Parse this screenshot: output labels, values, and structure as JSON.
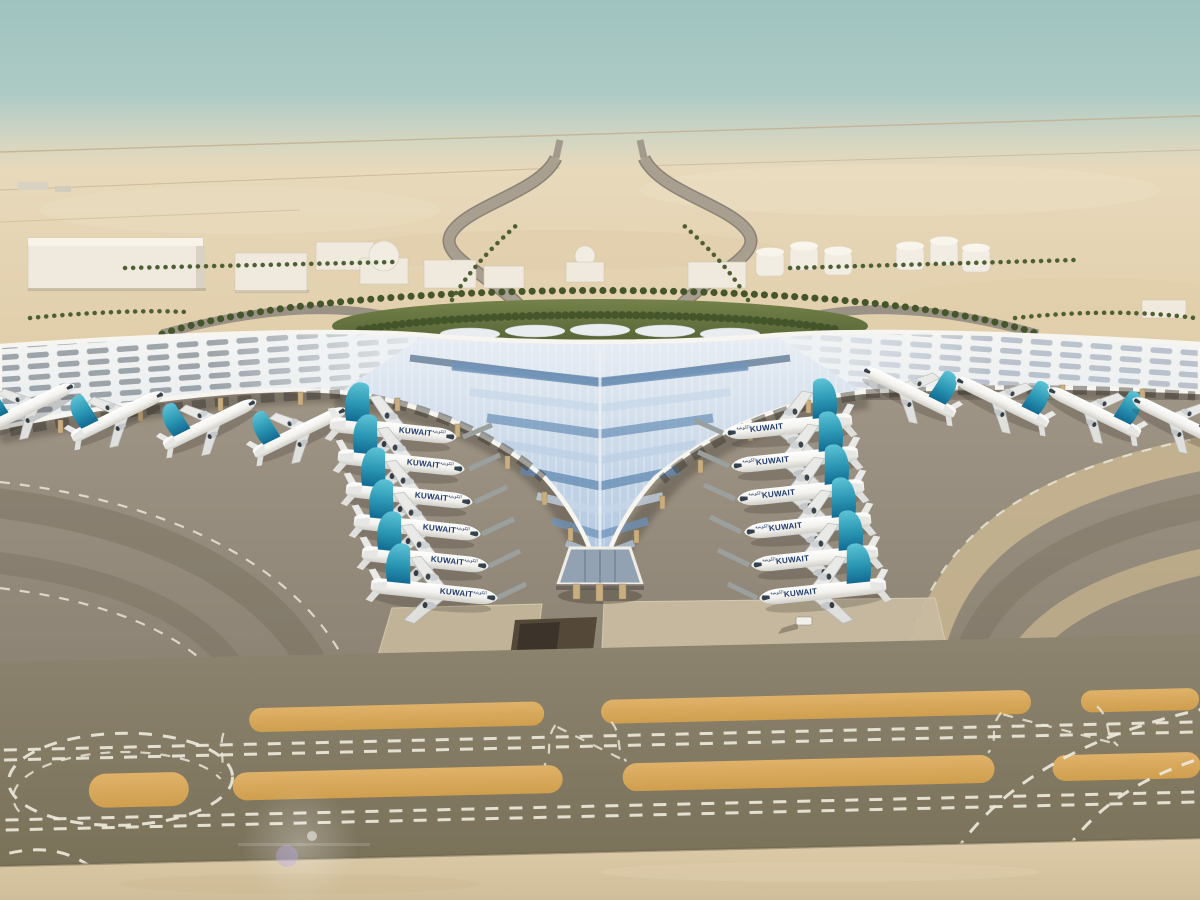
{
  "scene": {
    "subject": "Kuwait International Airport Terminal 2 — aerial architectural rendering",
    "airline_title": "KUWAIT",
    "airline_title_arabic": "الكويتية",
    "aircraft": {
      "left_gate_row_count": 6,
      "right_gate_row_count": 6,
      "left_wing_row_count": 4,
      "right_wing_row_count": 4,
      "livery": {
        "fuselage": "#f2f2ef",
        "tail_top": "#5ec4d6",
        "tail_base": "#136a92",
        "title_color": "#1e3a6e"
      }
    },
    "colors": {
      "sky_top": "#9fc3c0",
      "sky_horizon": "#d3d4c1",
      "desert_sand": "#e4d2b0",
      "roof_white": "#f7f5ef",
      "roof_glass_light": "#c7d7e8",
      "roof_glass_dark": "#5a7694",
      "landscape_green": "#5c6c38",
      "apron_concrete": "#968c7d",
      "taxiway": "#857b64",
      "shoulder_orange": "#d8a95c",
      "marking_white": "#ece8db",
      "column_tan": "#c9ae82",
      "foreground_sand": "#d8c6a4"
    }
  }
}
